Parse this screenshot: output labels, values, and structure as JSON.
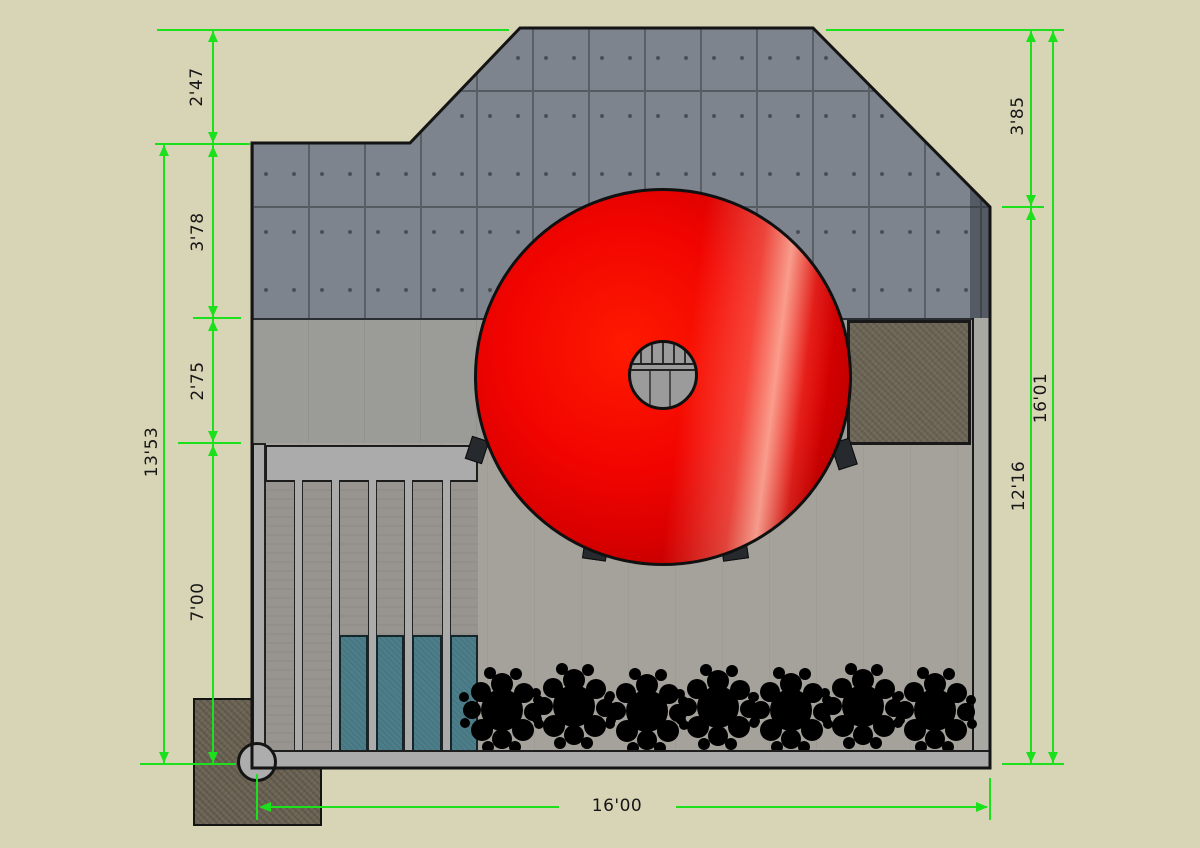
{
  "drawing": {
    "type": "building-elevation",
    "style": "sketchup-dimensioned-drawing"
  },
  "colors": {
    "background": "#d8d5b6",
    "dimension_green": "#1ce01c",
    "concrete_panel": "#7d848d",
    "mid_wall": "#9b9c97",
    "lower_wall": "#a5a29c",
    "trim_gray": "#ababab",
    "teal_panel": "#4c7e8a",
    "brown_panel": "#6e6757",
    "foundation_brown": "#6b6353",
    "torus_red": "#e60000",
    "shrub_black": "#000000"
  },
  "dimensions": {
    "left": [
      {
        "id": "roof-peak-offset",
        "value": "2'47"
      },
      {
        "id": "upper-concrete-band",
        "value": "3'78"
      },
      {
        "id": "middle-band",
        "value": "2'75"
      },
      {
        "id": "lower-band",
        "value": "7'00"
      },
      {
        "id": "left-overall",
        "value": "13'53"
      }
    ],
    "right": [
      {
        "id": "roof-drop",
        "value": "3'85"
      },
      {
        "id": "right-overall",
        "value": "16'01"
      },
      {
        "id": "right-lower",
        "value": "12'16"
      }
    ],
    "bottom": [
      {
        "id": "overall-width",
        "value": "16'00"
      }
    ]
  }
}
